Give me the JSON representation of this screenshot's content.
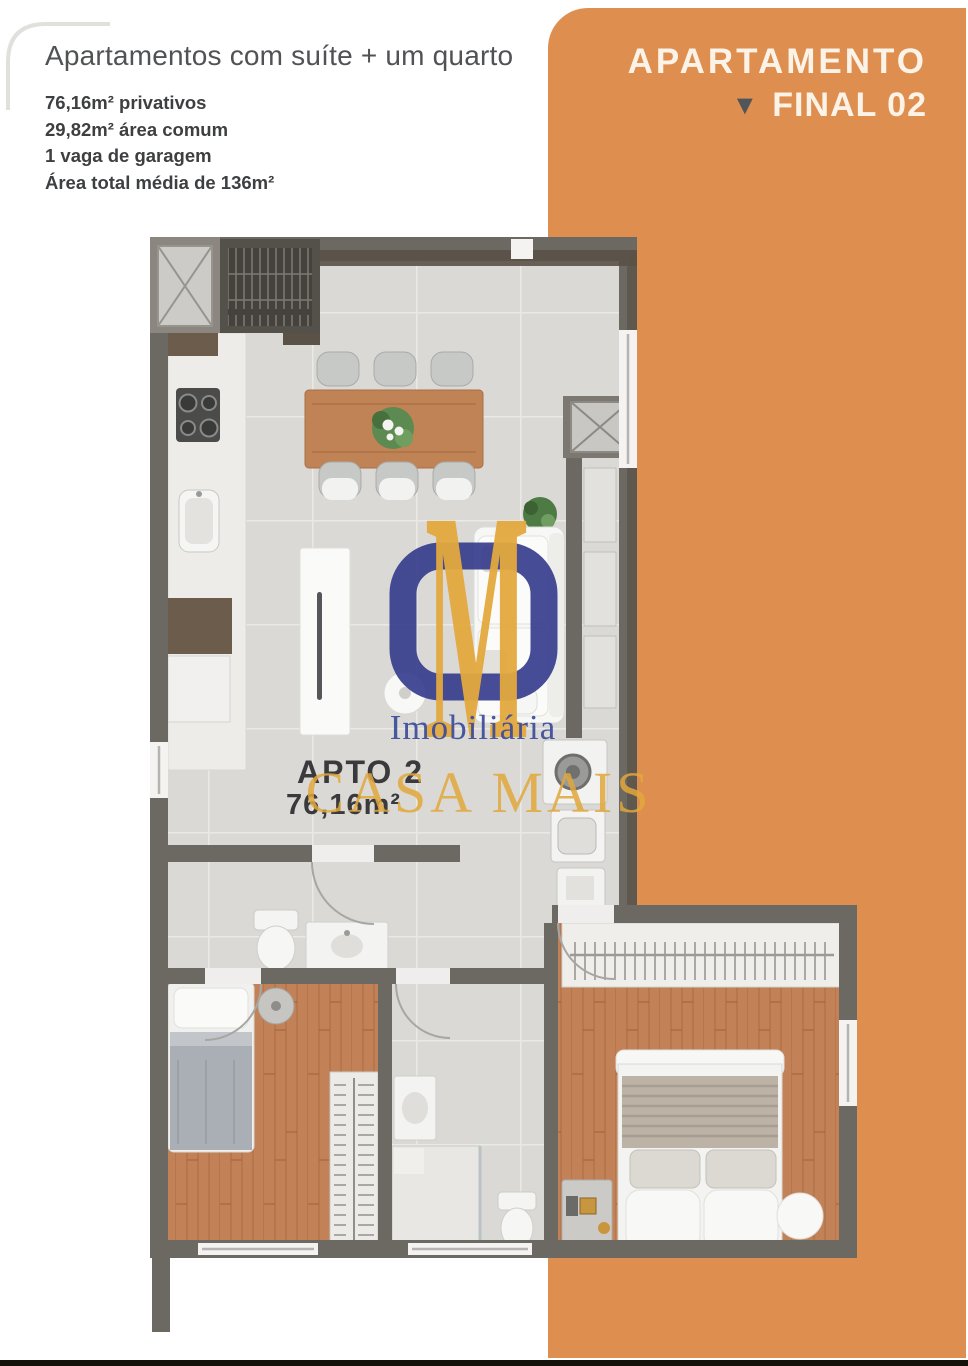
{
  "header": {
    "title": "Apartamentos com suíte + um quarto",
    "details": [
      "76,16m² privativos",
      "29,82m² área comum",
      "1 vaga de garagem",
      "Área total média de 136m²"
    ]
  },
  "badge": {
    "line1": "APARTAMENTO",
    "line2": "FINAL 02",
    "triangle_glyph": "▼"
  },
  "plan_label": {
    "name": "APTO 2",
    "area": "76,16m²"
  },
  "watermark": {
    "logo_m": "M",
    "brand_line1": "Imobiliária",
    "brand_line2": "CASA MAIS"
  },
  "colors": {
    "accent_orange": "#DE8E4E",
    "badge_text": "#FBF3E8",
    "triangle": "#50555A",
    "wall_gray": "#6C6862",
    "beam_brown": "#5A5147",
    "tile_floor": "#DAD9D6",
    "wood_floor": "#C28157",
    "logo_blue": "#383E8D",
    "logo_gold": "#E3A93E",
    "title_gray": "#515254",
    "detail_gray": "#3E3F41"
  }
}
